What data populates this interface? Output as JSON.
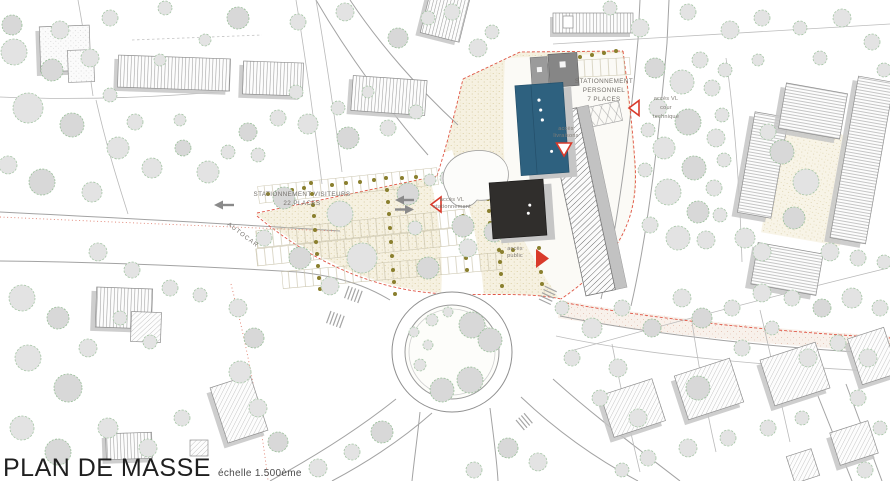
{
  "title": {
    "main": "PLAN DE MASSE",
    "scale": "échelle 1.500ème"
  },
  "labels": {
    "visitor_parking": {
      "line1": "STATIONNEMENT VISITEURS",
      "line2": "22 PLACES"
    },
    "autocar": "AUTOCAR",
    "staff_parking": {
      "line1": "STATIONNEMENT",
      "line2": "PERSONNEL",
      "line3": "7 PLACES"
    },
    "access_vl_stationnement": {
      "line1": "accès VL",
      "line2": "stationnement"
    },
    "access_public": {
      "line1": "accès",
      "line2": "public"
    },
    "access_livraisons": {
      "line1": "accès",
      "line2": "livraisons"
    },
    "access_vl_cour_technique": {
      "line1": "accès VL",
      "line2": "cour",
      "line3": "technique"
    }
  },
  "icons": {
    "red_arrow_solid_right": "solid red triangle pointing right (public access)",
    "red_arrow_outline_left_parking": "outlined red triangle pointing left (VL parking access)",
    "red_arrow_outline_down": "outlined red triangle pointing down (deliveries access)",
    "red_arrow_outline_left_technical": "outlined red triangle pointing left (VL technical yard access)",
    "gray_arrow_left": "gray direction arrow pointing left",
    "gray_arrow_right": "gray direction arrow pointing right"
  },
  "colors": {
    "accent_red": "#e05545",
    "building_blue": "#2e617f",
    "building_dark": "#302e2c",
    "building_gray": "#8a8a8a",
    "tree_green": "#a6c6a6",
    "shrub_olive": "#8a7f2e",
    "parking_cream": "#f6f1e1",
    "road_gray": "#a3a3a3",
    "label_gray": "#75716c"
  }
}
